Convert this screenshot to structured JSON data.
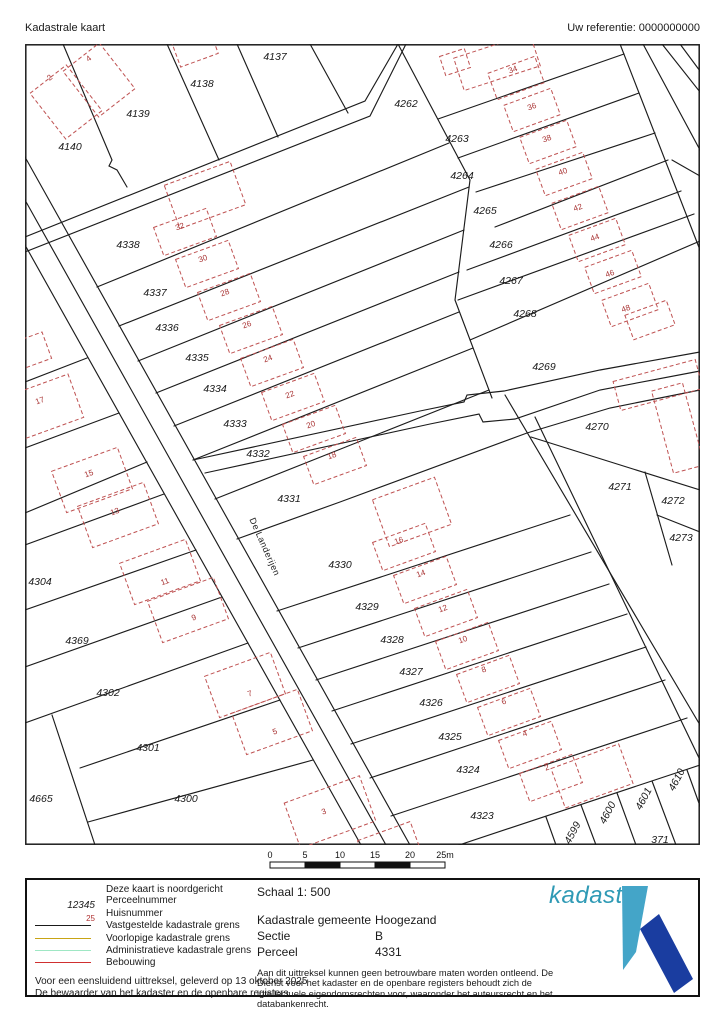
{
  "header": {
    "title": "Kadastrale kaart",
    "reference": "Uw referentie: 0000000000"
  },
  "map": {
    "stroke_color": "#1c1c1c",
    "building_color": "#bf5252",
    "house_number_color": "#a83232",
    "parcel_text_color": "#1a1a1a",
    "street_label": {
      "text": "De Landerijen",
      "x": 262,
      "y": 548,
      "rot": 66
    },
    "boundaries": [
      "M25,245 L361,845",
      "M25,200 L386,845",
      "M25,157 L410,845",
      "M193,460 L420,411 L464,402 L467,395 L504,391 L600,370 L700,352",
      "M205,473 L430,424 L479,414 L483,422 L515,419 L600,390 L700,371",
      "M237,539 L340,502 L527,433 L610,408 L700,390",
      "M505,395 L700,725",
      "M535,417 L700,760",
      "M25,237 L365,101 L398,44",
      "M25,252 L370,116 L406,44",
      "M63,44 L112,160 L109,166 L117,170 L127,187",
      "M167,44 L219,160",
      "M237,44 L278,137",
      "M310,44 L348,113",
      "M398,44 L470,180 L455,300 L492,398",
      "M620,44 L700,250",
      "M643,44 L700,150",
      "M662,44 L700,92",
      "M680,44 L700,71",
      "M672,160 L700,176",
      "M438,119 L624,54",
      "M458,158 L639,93",
      "M476,192 L655,133",
      "M495,227 L668,160",
      "M467,270 L681,191",
      "M458,300 L694,214",
      "M470,340 L700,241",
      "M97,287 L449,143",
      "M119,326 L469,187",
      "M138,361 L464,230",
      "M156,393 L459,272",
      "M174,426 L459,312",
      "M193,460 L473,348",
      "M215,499 L489,390",
      "M277,611 L570,515",
      "M298,648 L591,552",
      "M316,680 L609,584",
      "M332,711 L627,614",
      "M351,744 L646,647",
      "M370,778 L665,680",
      "M391,816 L687,718",
      "M459,845 L700,765",
      "M546,817 L556,845",
      "M581,805 L596,845",
      "M617,793 L636,845",
      "M652,781 L676,845",
      "M687,770 L700,806",
      "M25,545 L164,494",
      "M25,610 L196,550",
      "M25,667 L222,597",
      "M25,723 L248,643",
      "M80,768 L280,700",
      "M52,715 L95,845",
      "M88,822 L313,760",
      "M25,382 L87,358",
      "M25,448 L119,413",
      "M25,513 L147,462",
      "M531,437 L700,490",
      "M645,472 L672,565",
      "M657,515 L700,532"
    ],
    "buildings": [
      {
        "cx": 66,
        "cy": 102,
        "w": 46,
        "h": 58,
        "rot": -38
      },
      {
        "cx": 99,
        "cy": 80,
        "w": 46,
        "h": 58,
        "rot": -38
      },
      {
        "cx": 195,
        "cy": 48,
        "w": 40,
        "h": 26,
        "rot": -20
      },
      {
        "cx": 205,
        "cy": 195,
        "w": 70,
        "h": 46,
        "rot": -20
      },
      {
        "cx": 185,
        "cy": 232,
        "w": 56,
        "h": 30,
        "rot": -20
      },
      {
        "cx": 207,
        "cy": 264,
        "w": 56,
        "h": 30,
        "rot": -20
      },
      {
        "cx": 229,
        "cy": 297,
        "w": 56,
        "h": 30,
        "rot": -20
      },
      {
        "cx": 251,
        "cy": 330,
        "w": 56,
        "h": 30,
        "rot": -20
      },
      {
        "cx": 272,
        "cy": 363,
        "w": 56,
        "h": 30,
        "rot": -20
      },
      {
        "cx": 293,
        "cy": 397,
        "w": 56,
        "h": 30,
        "rot": -20
      },
      {
        "cx": 314,
        "cy": 429,
        "w": 56,
        "h": 30,
        "rot": -20
      },
      {
        "cx": 335,
        "cy": 461,
        "w": 56,
        "h": 30,
        "rot": -20
      },
      {
        "cx": 497,
        "cy": 62,
        "w": 80,
        "h": 34,
        "rot": -18
      },
      {
        "cx": 455,
        "cy": 62,
        "w": 26,
        "h": 20,
        "rot": -18
      },
      {
        "cx": 516,
        "cy": 78,
        "w": 50,
        "h": 28,
        "rot": -20
      },
      {
        "cx": 532,
        "cy": 110,
        "w": 50,
        "h": 28,
        "rot": -20
      },
      {
        "cx": 548,
        "cy": 142,
        "w": 50,
        "h": 28,
        "rot": -20
      },
      {
        "cx": 564,
        "cy": 174,
        "w": 50,
        "h": 28,
        "rot": -20
      },
      {
        "cx": 580,
        "cy": 208,
        "w": 50,
        "h": 28,
        "rot": -20
      },
      {
        "cx": 597,
        "cy": 240,
        "w": 50,
        "h": 28,
        "rot": -20
      },
      {
        "cx": 613,
        "cy": 272,
        "w": 50,
        "h": 28,
        "rot": -20
      },
      {
        "cx": 630,
        "cy": 305,
        "w": 50,
        "h": 28,
        "rot": -20
      },
      {
        "cx": 650,
        "cy": 320,
        "w": 44,
        "h": 26,
        "rot": -20
      },
      {
        "cx": 412,
        "cy": 512,
        "w": 66,
        "h": 50,
        "rot": -20
      },
      {
        "cx": 404,
        "cy": 547,
        "w": 56,
        "h": 30,
        "rot": -20
      },
      {
        "cx": 425,
        "cy": 580,
        "w": 56,
        "h": 30,
        "rot": -20
      },
      {
        "cx": 446,
        "cy": 613,
        "w": 56,
        "h": 30,
        "rot": -20
      },
      {
        "cx": 467,
        "cy": 646,
        "w": 56,
        "h": 30,
        "rot": -20
      },
      {
        "cx": 488,
        "cy": 679,
        "w": 56,
        "h": 30,
        "rot": -20
      },
      {
        "cx": 509,
        "cy": 712,
        "w": 56,
        "h": 30,
        "rot": -20
      },
      {
        "cx": 530,
        "cy": 745,
        "w": 56,
        "h": 30,
        "rot": -20
      },
      {
        "cx": 551,
        "cy": 778,
        "w": 56,
        "h": 30,
        "rot": -20
      },
      {
        "cx": 592,
        "cy": 776,
        "w": 72,
        "h": 42,
        "rot": -20
      },
      {
        "cx": 42,
        "cy": 408,
        "w": 72,
        "h": 46,
        "rot": -20
      },
      {
        "cx": 28,
        "cy": 352,
        "w": 40,
        "h": 28,
        "rot": -20
      },
      {
        "cx": 92,
        "cy": 480,
        "w": 70,
        "h": 44,
        "rot": -20
      },
      {
        "cx": 118,
        "cy": 515,
        "w": 70,
        "h": 44,
        "rot": -20
      },
      {
        "cx": 160,
        "cy": 572,
        "w": 70,
        "h": 44,
        "rot": -20
      },
      {
        "cx": 188,
        "cy": 610,
        "w": 70,
        "h": 44,
        "rot": -20
      },
      {
        "cx": 245,
        "cy": 685,
        "w": 70,
        "h": 44,
        "rot": -20
      },
      {
        "cx": 272,
        "cy": 722,
        "w": 70,
        "h": 44,
        "rot": -20
      },
      {
        "cx": 330,
        "cy": 812,
        "w": 80,
        "h": 48,
        "rot": -20
      },
      {
        "cx": 390,
        "cy": 848,
        "w": 56,
        "h": 36,
        "rot": -20
      },
      {
        "cx": 658,
        "cy": 385,
        "w": 85,
        "h": 30,
        "rot": -15
      },
      {
        "cx": 678,
        "cy": 428,
        "w": 32,
        "h": 85,
        "rot": -15
      }
    ],
    "parcel_labels": [
      {
        "text": "4137",
        "x": 275,
        "y": 57
      },
      {
        "text": "4138",
        "x": 202,
        "y": 84
      },
      {
        "text": "4139",
        "x": 138,
        "y": 114
      },
      {
        "text": "4140",
        "x": 70,
        "y": 147
      },
      {
        "text": "4338",
        "x": 128,
        "y": 245
      },
      {
        "text": "4337",
        "x": 155,
        "y": 293
      },
      {
        "text": "4336",
        "x": 167,
        "y": 328
      },
      {
        "text": "4335",
        "x": 197,
        "y": 358
      },
      {
        "text": "4334",
        "x": 215,
        "y": 389
      },
      {
        "text": "4333",
        "x": 235,
        "y": 424
      },
      {
        "text": "4332",
        "x": 258,
        "y": 454
      },
      {
        "text": "4331",
        "x": 289,
        "y": 499
      },
      {
        "text": "4262",
        "x": 406,
        "y": 104
      },
      {
        "text": "4263",
        "x": 457,
        "y": 139
      },
      {
        "text": "4264",
        "x": 462,
        "y": 176
      },
      {
        "text": "4265",
        "x": 485,
        "y": 211
      },
      {
        "text": "4266",
        "x": 501,
        "y": 245
      },
      {
        "text": "4267",
        "x": 511,
        "y": 281
      },
      {
        "text": "4268",
        "x": 525,
        "y": 314
      },
      {
        "text": "4269",
        "x": 544,
        "y": 367
      },
      {
        "text": "4270",
        "x": 597,
        "y": 427
      },
      {
        "text": "4271",
        "x": 620,
        "y": 487
      },
      {
        "text": "4272",
        "x": 673,
        "y": 501
      },
      {
        "text": "4273",
        "x": 681,
        "y": 538
      },
      {
        "text": "4330",
        "x": 340,
        "y": 565
      },
      {
        "text": "4329",
        "x": 367,
        "y": 607
      },
      {
        "text": "4328",
        "x": 392,
        "y": 640
      },
      {
        "text": "4327",
        "x": 411,
        "y": 672
      },
      {
        "text": "4326",
        "x": 431,
        "y": 703
      },
      {
        "text": "4325",
        "x": 450,
        "y": 737
      },
      {
        "text": "4324",
        "x": 468,
        "y": 770
      },
      {
        "text": "4323",
        "x": 482,
        "y": 816
      },
      {
        "text": "4304",
        "x": 40,
        "y": 582
      },
      {
        "text": "4369",
        "x": 77,
        "y": 641
      },
      {
        "text": "4302",
        "x": 108,
        "y": 693
      },
      {
        "text": "4301",
        "x": 148,
        "y": 748
      },
      {
        "text": "4300",
        "x": 186,
        "y": 799
      },
      {
        "text": "4665",
        "x": 41,
        "y": 799
      },
      {
        "text": "371",
        "x": 660,
        "y": 840
      },
      {
        "text": "4599",
        "x": 573,
        "y": 833,
        "rot": -62
      },
      {
        "text": "4600",
        "x": 608,
        "y": 813,
        "rot": -62
      },
      {
        "text": "4601",
        "x": 644,
        "y": 799,
        "rot": -62
      },
      {
        "text": "4610",
        "x": 677,
        "y": 780,
        "rot": -62
      }
    ],
    "house_numbers": [
      {
        "text": "2",
        "x": 50,
        "y": 78,
        "rot": -38
      },
      {
        "text": "4",
        "x": 89,
        "y": 59,
        "rot": -38
      },
      {
        "text": "32",
        "x": 180,
        "y": 227,
        "rot": -20
      },
      {
        "text": "30",
        "x": 203,
        "y": 259,
        "rot": -20
      },
      {
        "text": "28",
        "x": 225,
        "y": 293,
        "rot": -20
      },
      {
        "text": "26",
        "x": 247,
        "y": 325,
        "rot": -20
      },
      {
        "text": "24",
        "x": 268,
        "y": 359,
        "rot": -20
      },
      {
        "text": "22",
        "x": 290,
        "y": 395,
        "rot": -20
      },
      {
        "text": "20",
        "x": 311,
        "y": 425,
        "rot": -20
      },
      {
        "text": "18",
        "x": 332,
        "y": 456,
        "rot": -20
      },
      {
        "text": "34",
        "x": 513,
        "y": 70,
        "rot": -20
      },
      {
        "text": "36",
        "x": 532,
        "y": 107,
        "rot": -20
      },
      {
        "text": "38",
        "x": 547,
        "y": 139,
        "rot": -20
      },
      {
        "text": "40",
        "x": 563,
        "y": 172,
        "rot": -20
      },
      {
        "text": "42",
        "x": 578,
        "y": 208,
        "rot": -20
      },
      {
        "text": "44",
        "x": 595,
        "y": 238,
        "rot": -20
      },
      {
        "text": "46",
        "x": 610,
        "y": 274,
        "rot": -20
      },
      {
        "text": "48",
        "x": 626,
        "y": 309,
        "rot": -20
      },
      {
        "text": "16",
        "x": 399,
        "y": 541,
        "rot": -20
      },
      {
        "text": "14",
        "x": 421,
        "y": 574,
        "rot": -20
      },
      {
        "text": "12",
        "x": 443,
        "y": 609,
        "rot": -20
      },
      {
        "text": "10",
        "x": 463,
        "y": 640,
        "rot": -20
      },
      {
        "text": "8",
        "x": 484,
        "y": 670,
        "rot": -20
      },
      {
        "text": "6",
        "x": 504,
        "y": 702,
        "rot": -20
      },
      {
        "text": "4",
        "x": 525,
        "y": 734,
        "rot": -20
      },
      {
        "text": "2",
        "x": 547,
        "y": 768,
        "rot": -20
      },
      {
        "text": "17",
        "x": 40,
        "y": 401,
        "rot": -20
      },
      {
        "text": "15",
        "x": 89,
        "y": 474,
        "rot": -20
      },
      {
        "text": "13",
        "x": 115,
        "y": 512,
        "rot": -20
      },
      {
        "text": "11",
        "x": 165,
        "y": 582,
        "rot": -20
      },
      {
        "text": "9",
        "x": 194,
        "y": 618,
        "rot": -20
      },
      {
        "text": "7",
        "x": 250,
        "y": 694,
        "rot": -20
      },
      {
        "text": "5",
        "x": 275,
        "y": 732,
        "rot": -20
      },
      {
        "text": "3",
        "x": 324,
        "y": 812,
        "rot": -20
      }
    ]
  },
  "scalebar": {
    "labels": [
      "0",
      "5",
      "10",
      "15",
      "20",
      "25m"
    ],
    "segments": 5,
    "segment_px": 35,
    "fills": [
      "#ffffff",
      "#111111",
      "#ffffff",
      "#111111",
      "#ffffff"
    ]
  },
  "legend": {
    "north_note": "Deze kaart is noordgericht",
    "items": [
      {
        "symbol": "text-italic",
        "symbol_text": "12345",
        "label": "Perceelnummer"
      },
      {
        "symbol": "text-red",
        "symbol_text": "25",
        "label": "Huisnummer"
      },
      {
        "symbol": "line",
        "color": "#1a1a1a",
        "label": "Vastgestelde kadastrale grens"
      },
      {
        "symbol": "line",
        "color": "#c8a415",
        "label": "Voorlopige kadastrale grens"
      },
      {
        "symbol": "line",
        "color": "#9fe7c4",
        "label": "Administratieve kadastrale grens"
      },
      {
        "symbol": "line",
        "color": "#d03030",
        "label": "Bebouwing"
      }
    ],
    "issued_line1": "Voor een eensluidend uittreksel, geleverd op 13 oktober 2025",
    "issued_line2": "De bewaarder van het kadaster en de openbare registers",
    "schaal": "Schaal 1: 500",
    "fields": [
      {
        "label": "Kadastrale gemeente",
        "value": "Hoogezand"
      },
      {
        "label": "Sectie",
        "value": "B"
      },
      {
        "label": "Perceel",
        "value": "4331"
      }
    ],
    "disclaimer": "Aan dit uittreksel kunnen geen betrouwbare maten worden ontleend. De Dienst voor het kadaster en de openbare registers behoudt zich de intellectuele eigendomsrechten voor, waaronder het auteursrecht en het databankenrecht."
  },
  "logo": {
    "text": "kadaster",
    "text_color": "#2f9ab5",
    "light_color": "#44a5c8",
    "dark_color": "#1a3da0"
  }
}
